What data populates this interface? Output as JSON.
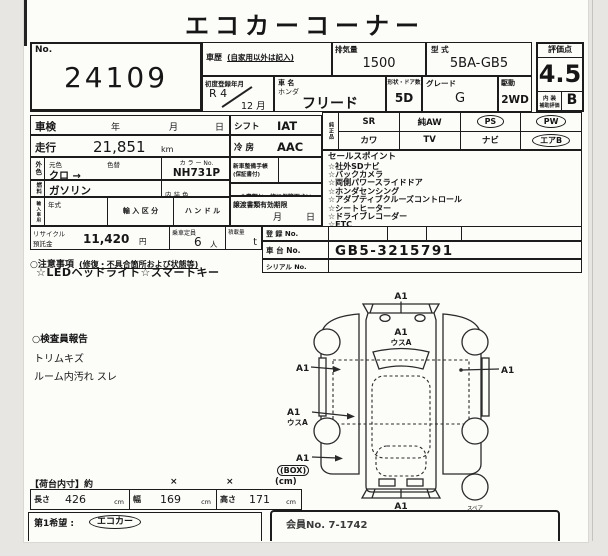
{
  "title": "エコカーコーナー",
  "top": {
    "lot": {
      "no_label": "No.",
      "number": "24109"
    },
    "history": {
      "label": "車歴",
      "note": "(自家用以外は記入)"
    },
    "displacement": {
      "label": "排気量",
      "value": "1500"
    },
    "model_code": {
      "label": "型 式",
      "value": "5BA-GB5"
    },
    "first_reg": {
      "label": "初度登録年月",
      "era_year": "R 4",
      "month": "12 月"
    },
    "car": {
      "label": "車 名",
      "maker": "ホンダ",
      "name": "フリード"
    },
    "doors": {
      "label": "形状・ドア数",
      "value": "5D"
    },
    "grade": {
      "label": "グレード",
      "value": "G"
    },
    "drive": {
      "label": "駆動",
      "value": "2WD"
    },
    "score": {
      "label": "評価点",
      "value": "4.5",
      "interior_label1": "内 装",
      "interior_label2": "補助評価",
      "interior_value": "B"
    }
  },
  "details": {
    "shaken": {
      "label": "車検",
      "year": "年",
      "month": "月",
      "day": "日"
    },
    "mileage": {
      "label": "走行",
      "value": "21,851",
      "unit": "km"
    },
    "color": {
      "vlabel": "外色",
      "base_label": "元色",
      "base": "クロ →",
      "change_label": "色替",
      "color_no_label": "カ ラ ー No.",
      "color_no": "NH731P"
    },
    "fuel": {
      "vlabel": "燃料",
      "value": "ガソリン",
      "interior_label": "内 装 色"
    },
    "import": {
      "vlabel": "輸入車用",
      "year_label": "年式",
      "class_label": "輸 入 区 分",
      "handle_label": "ハ ン ド ル"
    },
    "recycle": {
      "label1": "リサイクル",
      "label2": "預託金",
      "value": "11,420",
      "unit": "円",
      "cap_label": "乗車定員",
      "cap": "6",
      "cap_unit": "人",
      "load_label": "積載量",
      "load_unit": "t"
    },
    "shift": {
      "label": "シフト",
      "value": "IAT"
    },
    "ac": {
      "label": "冷 房",
      "value": "AAC"
    },
    "service": {
      "label1": "新車整備手帳",
      "label2": "(保証書付)"
    },
    "keep_note": "※書類と一緒に保管下さい",
    "transfer": {
      "label": "譲渡書類有効期限",
      "month": "月",
      "day": "日"
    }
  },
  "equipment": {
    "vlabel": "純正品",
    "row1": [
      "SR",
      "純AW",
      "PS",
      "PW"
    ],
    "row2": [
      "カワ",
      "TV",
      "ナビ",
      "エアB"
    ],
    "circled": [
      "PS",
      "PW",
      "エアB"
    ]
  },
  "sales": {
    "header": "セールスポイント",
    "items": [
      "☆社外SDナビ",
      "☆バックカメラ",
      "☆両側パワースライドドア",
      "☆ホンダセンシング",
      "☆アダプティブクルーズコントロール",
      "☆シートヒーター",
      "☆ドライブレコーダー",
      "☆ETC"
    ]
  },
  "registration": {
    "reg_label": "登 録 No.",
    "chassis_label": "車 台 No.",
    "chassis": "GB5-3215791",
    "serial_label": "シリアル No."
  },
  "notes": {
    "header": "○注意事項",
    "header_note": "(修復・不具合箇所および状態等)",
    "line": "☆LEDヘッドライト☆スマートキー"
  },
  "inspector": {
    "header": "○検査員報告",
    "items": [
      "トリムキズ",
      "ルーム内汚れ スレ"
    ]
  },
  "diagram": {
    "marks": {
      "top": "A1",
      "hood1": "A1",
      "hood2": "ウスA",
      "left1": "A1",
      "left2a": "A1",
      "left2b": "ウスA",
      "left3": "A1",
      "right": "A1",
      "bottom": "A1"
    },
    "spare": "スペア"
  },
  "cargo": {
    "box_stamp": "(BOX)",
    "header": "【荷台内寸】約",
    "times1": "×",
    "times2": "×",
    "unit": "(cm)",
    "length_label": "長さ",
    "length": "426",
    "length_unit": "cm",
    "width_label": "幅",
    "width": "169",
    "width_unit": "cm",
    "height_label": "高さ",
    "height": "171",
    "height_unit": "cm"
  },
  "footer": {
    "wish_label": "第1希望 :",
    "wish_value": "エコカー",
    "member": "会員No. 7-1742"
  }
}
